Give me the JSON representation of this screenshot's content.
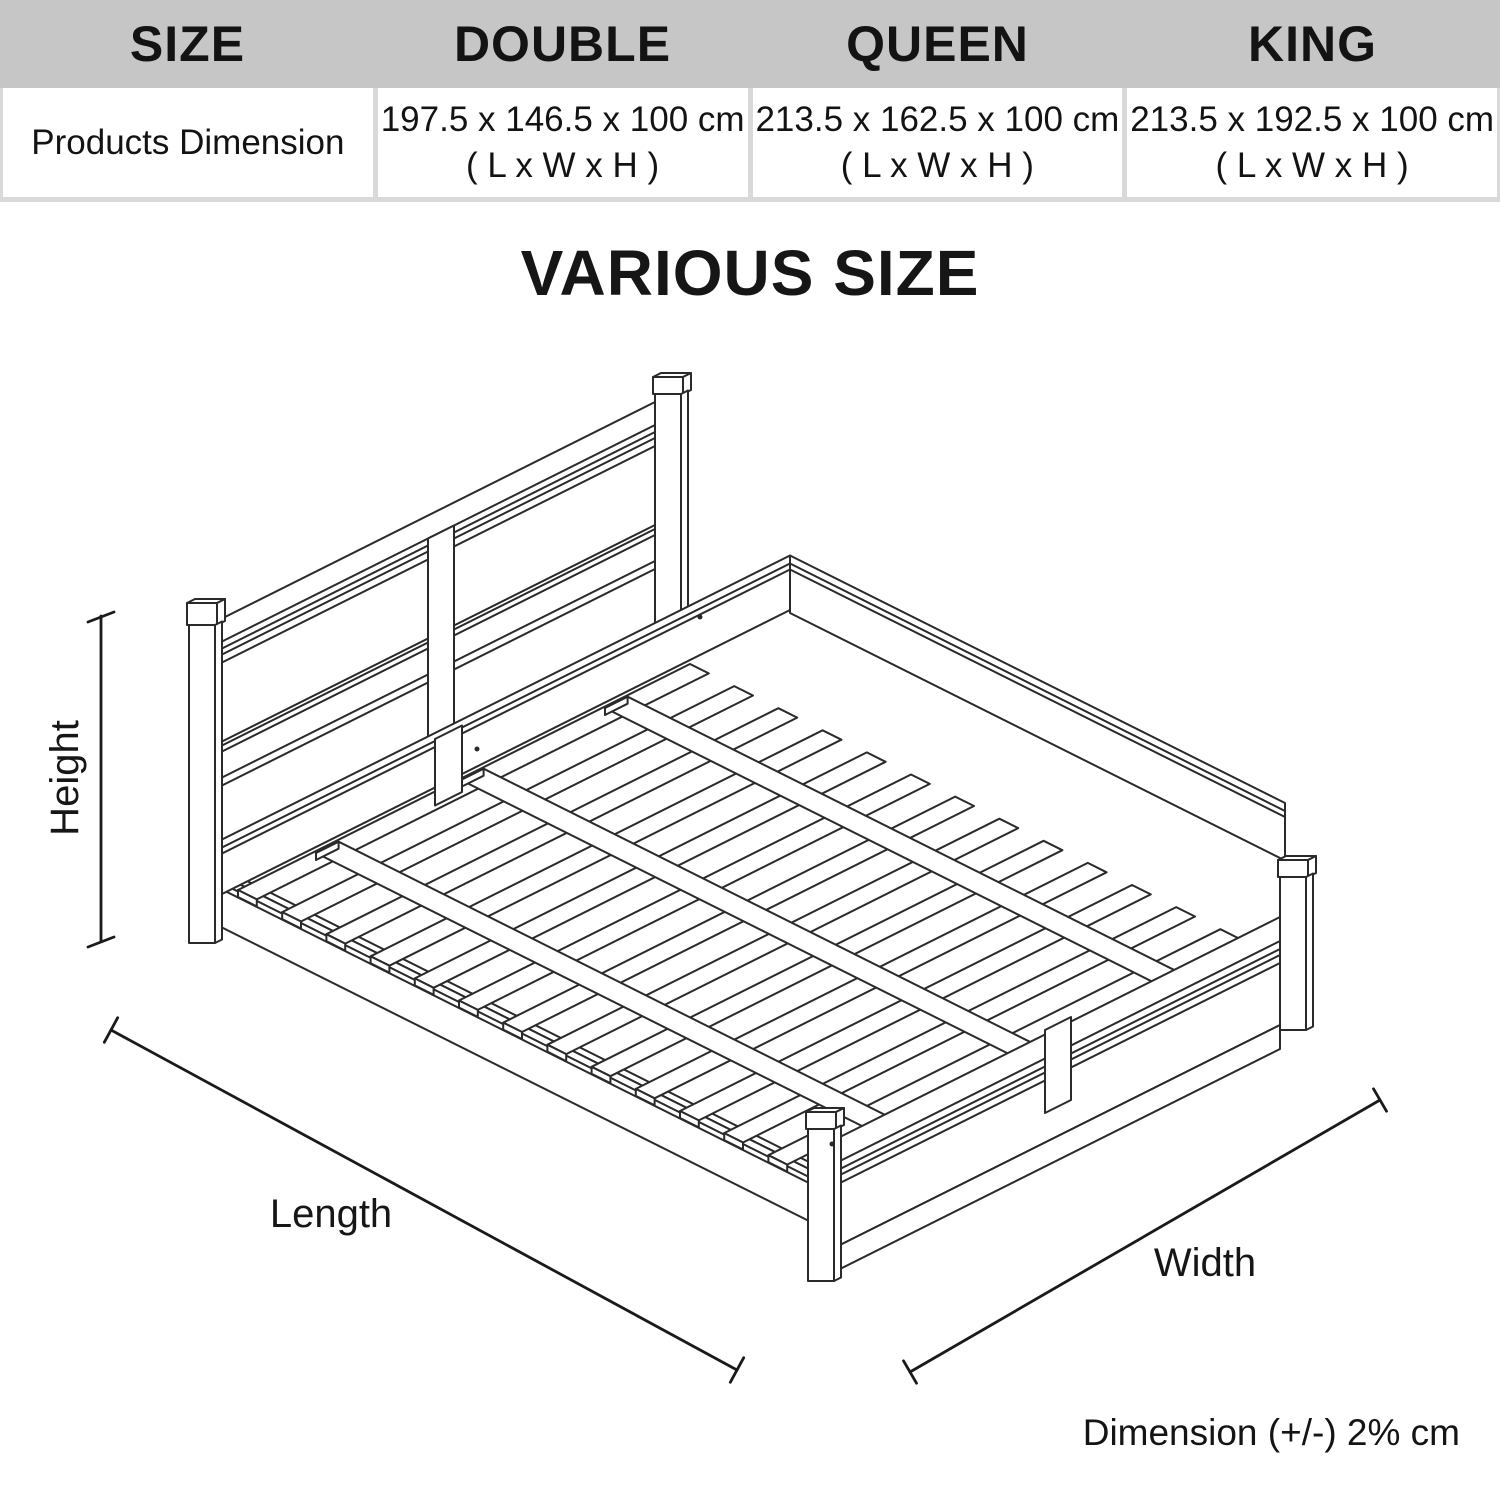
{
  "title": "VARIOUS SIZE",
  "table": {
    "col_headers": [
      "SIZE",
      "DOUBLE",
      "QUEEN",
      "KING"
    ],
    "row_header": "Products Dimension",
    "cells": [
      {
        "dimensions": "197.5 x 146.5 x 100 cm",
        "format": "( L x W x H )"
      },
      {
        "dimensions": "213.5 x 162.5 x 100 cm",
        "format": "( L x W x H )"
      },
      {
        "dimensions": "213.5 x 192.5 x 100 cm",
        "format": "( L x W x H )"
      }
    ]
  },
  "diagram": {
    "labels": {
      "height": "Height",
      "length": "Length",
      "width": "Width"
    },
    "note": "Dimension (+/-) 2% cm"
  },
  "colors": {
    "header_bg": "#c6c6c6",
    "table_border": "#d9d9d9",
    "line_color": "#2a2a2a",
    "text_color": "#131313"
  }
}
